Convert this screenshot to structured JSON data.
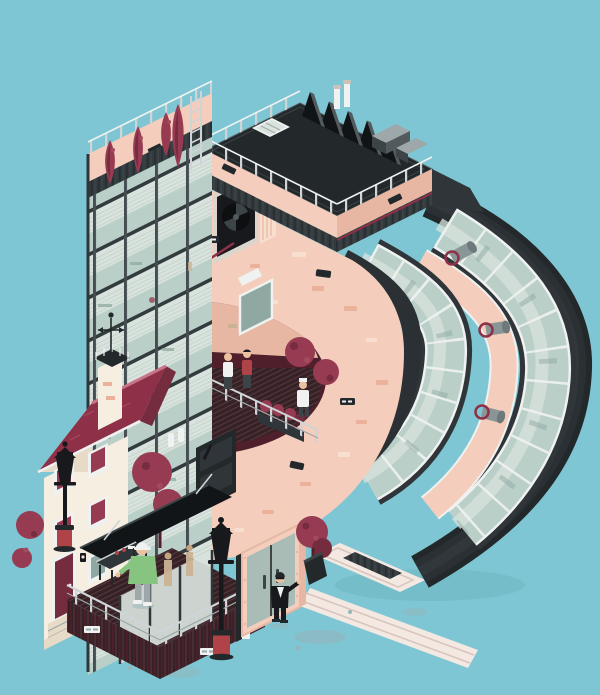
{
  "artwork": {
    "title": "Isometric illustration of a letter-shaped building on a teal background",
    "style": "flat isometric vector / pixel-art",
    "visible_text": "none (tiny illegible signage plaques only)"
  },
  "palette": {
    "bg": "#7EC6D3",
    "blob": "#96B5B9",
    "pave": "#F3E9E2",
    "paveLine": "#D8C4BC",
    "salmon": "#F4CDBC",
    "salmonD": "#E7B7A4",
    "brick": "#EAB19B",
    "brickL": "#F8DECE",
    "cream": "#F6EEE1",
    "creamS": "#E7DAC7",
    "maroon": "#963B51",
    "maroonD": "#762C3F",
    "maroonDeep": "#4F1F2B",
    "roofred": "#8E3148",
    "roofredL": "#A34A5E",
    "ridge": "#C97488",
    "char": "#2F3538",
    "charD": "#23282B",
    "charP1": "#2A3034",
    "charP2": "#31373B",
    "charM": "#3D4447",
    "charL": "#525A5E",
    "corr": "#343B3E",
    "corrLine": "#272D30",
    "corrHi": "#3F474B",
    "steel": "#A9BDB6",
    "metal": "#9EA7AA",
    "metalL": "#CFD5D6",
    "glass": "#B9CFC8",
    "glassL": "#D9E3DD",
    "glassD": "#8FA9A2",
    "blindLine": "#C4D2CC",
    "slab": "#333B3E",
    "mull": "#454D50",
    "white": "#EFF2F1",
    "redac": "#AF4348",
    "pipe": "#8A9597",
    "pipeD": "#6E797B",
    "green": "#86C47F",
    "skin": "#EAC29F",
    "tan": "#CBB294",
    "suit": "#17191C",
    "deck": "#362226",
    "deckLine": "#583A3F"
  },
  "scene": {
    "background": "flat teal sky and ground, soft gray puddle blobs",
    "main_structure": "tall glass-curtain tower forming the stem of a letter, with a curved dark-ribbon bowl of window bands and a large salmon inner face",
    "roof": "black roof deck with skylight, sawtooth solar array, chimneys, HVAC boxes, ladder and white railings",
    "mid_terrace": "cut-out balcony with dark plank deck, railing, two people talking, chef figure, maroon trees and planter, open white window, wall exhaust fan",
    "house": "small maroon-roofed cream row house with shuttered windows, chimney with weather vane, door with steps and a street lamp",
    "street_level": "glass lobby with canopy, railed deck with worker in green jacket and white helmet at a grill, black lantern street lamps with red bases, steel double doors in salmon frame, doorman in black suit, potted maroon tree, pale paved strip"
  }
}
